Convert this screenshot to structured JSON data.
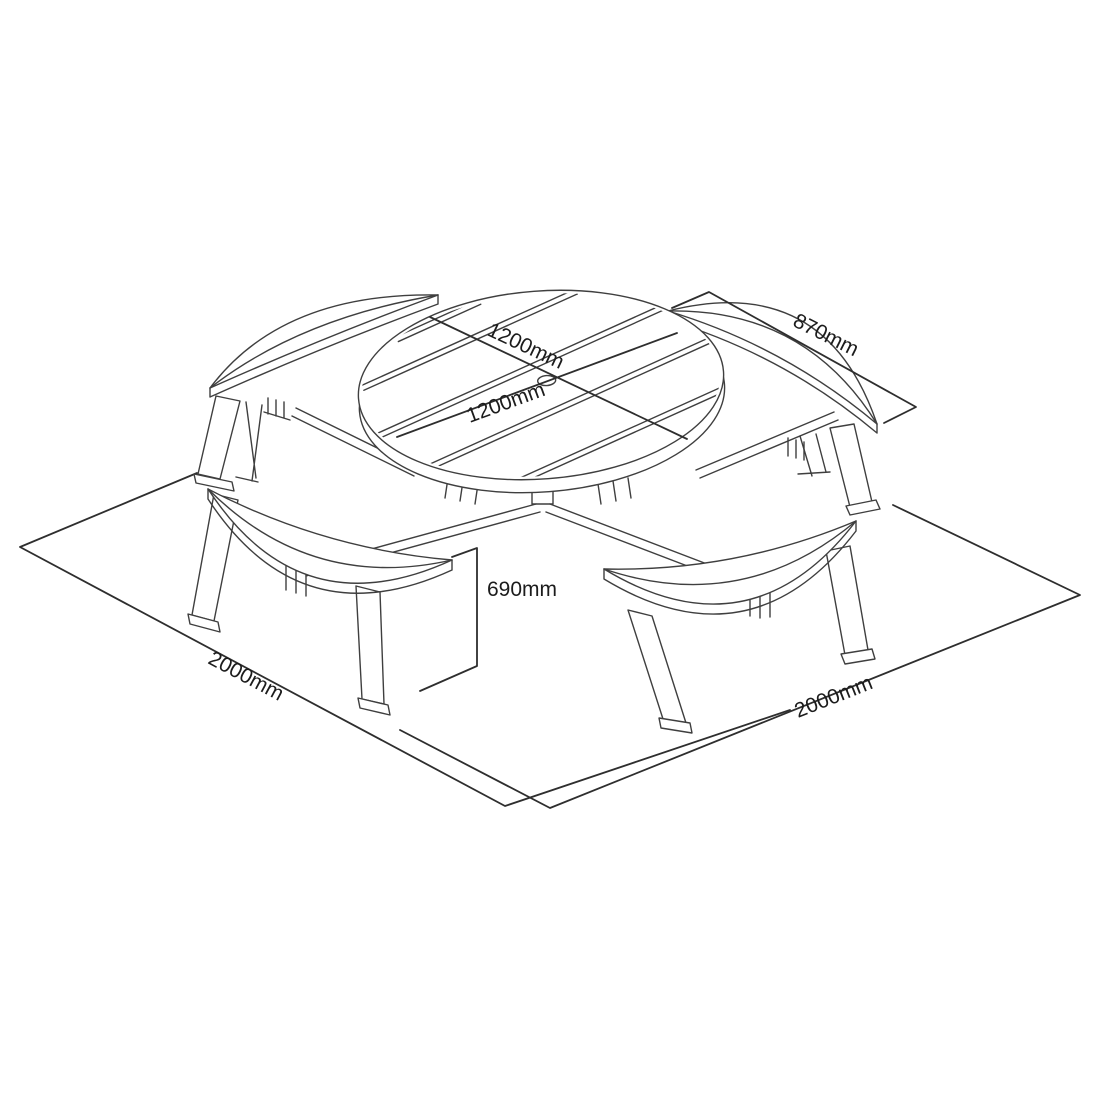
{
  "page": {
    "background": "#ffffff"
  },
  "diagram": {
    "line_color": "#3f3f3f",
    "dimension_line_color": "#2e2e2e",
    "text_color": "#1c1c1c",
    "labels": {
      "tabletop_diameter_1": "1200mm",
      "tabletop_diameter_2": "1200mm",
      "bench_length": "870mm",
      "height": "690mm",
      "footprint_left": "2000mm",
      "footprint_right": "2000mm"
    }
  }
}
